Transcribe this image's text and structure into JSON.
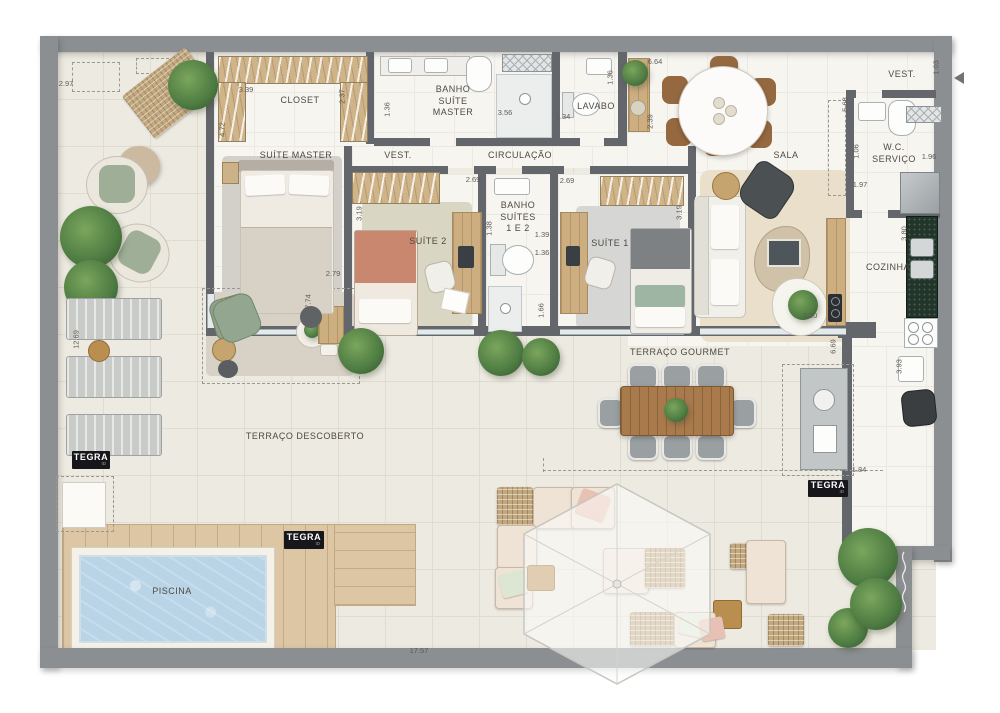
{
  "brand": {
    "name": "TEGRA",
    "sub": "ID"
  },
  "rooms": {
    "closet": "CLOSET",
    "suite_master": "SUÍTE MASTER",
    "vest_master": "VEST.",
    "banho_master": "BANHO\nSUÍTE\nMASTER",
    "lavabo": "LAVABO",
    "circulacao": "CIRCULAÇÃO",
    "banho_suites": "BANHO\nSUÍTES\n1 E 2",
    "suite2": "SUÍTE 2",
    "suite1": "SUÍTE 1",
    "sala": "SALA",
    "vest_entry": "VEST.",
    "wc_servico": "W.C.\nSERVIÇO",
    "cozinha": "COZINHA",
    "terraco_gourmet": "TERRAÇO GOURMET",
    "terraco_descoberto": "TERRAÇO DESCOBERTO",
    "piscina": "PISCINA"
  },
  "dims": [
    "2.97",
    "3.39",
    "2.37",
    "4.72",
    "1.36",
    "3.56",
    "1.34",
    "1.36",
    "6.64",
    "2.39",
    "1.03",
    "5.68",
    "1.06",
    "1.96",
    "1.97",
    "3.80",
    "2.69",
    "2.69",
    "3.19",
    "3.19",
    "1.38",
    "1.39",
    "1.36",
    "1.66",
    "2.79",
    "7.74",
    "3.20",
    "6.69",
    "3.93",
    "12.69",
    "1.84",
    "17.57"
  ],
  "icons": {
    "entry_arrow": "left-arrow"
  },
  "colors": {
    "outer_wall": "#8b8f91",
    "inner_wall": "#63676b",
    "terrace_tile": "#edeae1",
    "indoor_floor": "#f7f5f0",
    "wood": "#ccae80",
    "deck": "#dcc6a4",
    "pool_water": "#b9d4e7",
    "plant": "#4c7a41",
    "brand_bg": "#17171b"
  }
}
